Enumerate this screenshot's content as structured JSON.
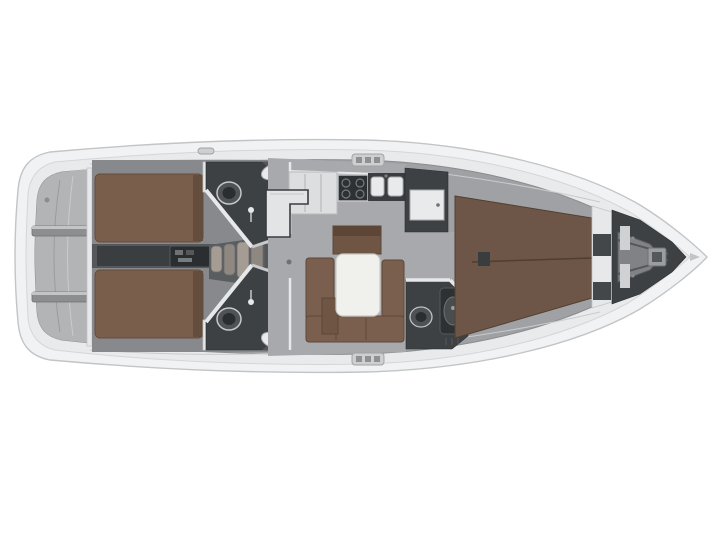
{
  "diagram": {
    "type": "yacht-interior-floor-plan",
    "view": "top-down",
    "orientation": "stern-left-bow-right"
  },
  "components": [
    "hull",
    "side-deck",
    "stern-swim-platform",
    "transom-steps",
    "aft-cabin-port-berth",
    "aft-cabin-starboard-berth",
    "engine-compartment",
    "companionway-steps",
    "aft-head-port",
    "aft-head-starboard",
    "toilet",
    "sink",
    "shower",
    "galley-lockers",
    "galley-stove",
    "galley-double-sink",
    "salon-table",
    "salon-u-settee",
    "salon-chest-seat",
    "salon-stool",
    "nav-counter",
    "mast-post",
    "wardrobe",
    "wardrobe-locker-door",
    "forward-head",
    "forward-shower-cabin",
    "forward-vberth",
    "collision-bulkhead",
    "anchor-locker",
    "windlass",
    "bow-fitting",
    "deck-cleat",
    "deck-clutch-bank-top",
    "deck-clutch-bank-bottom"
  ],
  "colors": {
    "background": "#ffffff",
    "hull": "#f1f2f3",
    "hull_stroke": "#c2c4c6",
    "deck": "#e9eaec",
    "deck_line": "#d4d6d7",
    "interior": "#9fa1a4",
    "interior_edge": "#8a8c8e",
    "platform": "#b2b4b6",
    "cabin_floor": "#87898c",
    "berth_brown": "#7a5e4c",
    "berth_edge": "#644d3c",
    "vberth_brown": "#6d5647",
    "vberth_edge": "#52402f",
    "settee_brown": "#7a5f4e",
    "settee_edge": "#5d4737",
    "chest_brown": "#6f5544",
    "table_white": "#f0f0ed",
    "room_dark": "#3e4144",
    "corridor": "#55585b",
    "corridor_dark": "#3b3e41",
    "engine": "#2b2e30",
    "fixture_white": "#e9eaeb",
    "counter_light": "#dcdedf",
    "stove_dark": "#2e3133",
    "floor_panel": "#808285",
    "wall_white": "#e6e8e9"
  }
}
